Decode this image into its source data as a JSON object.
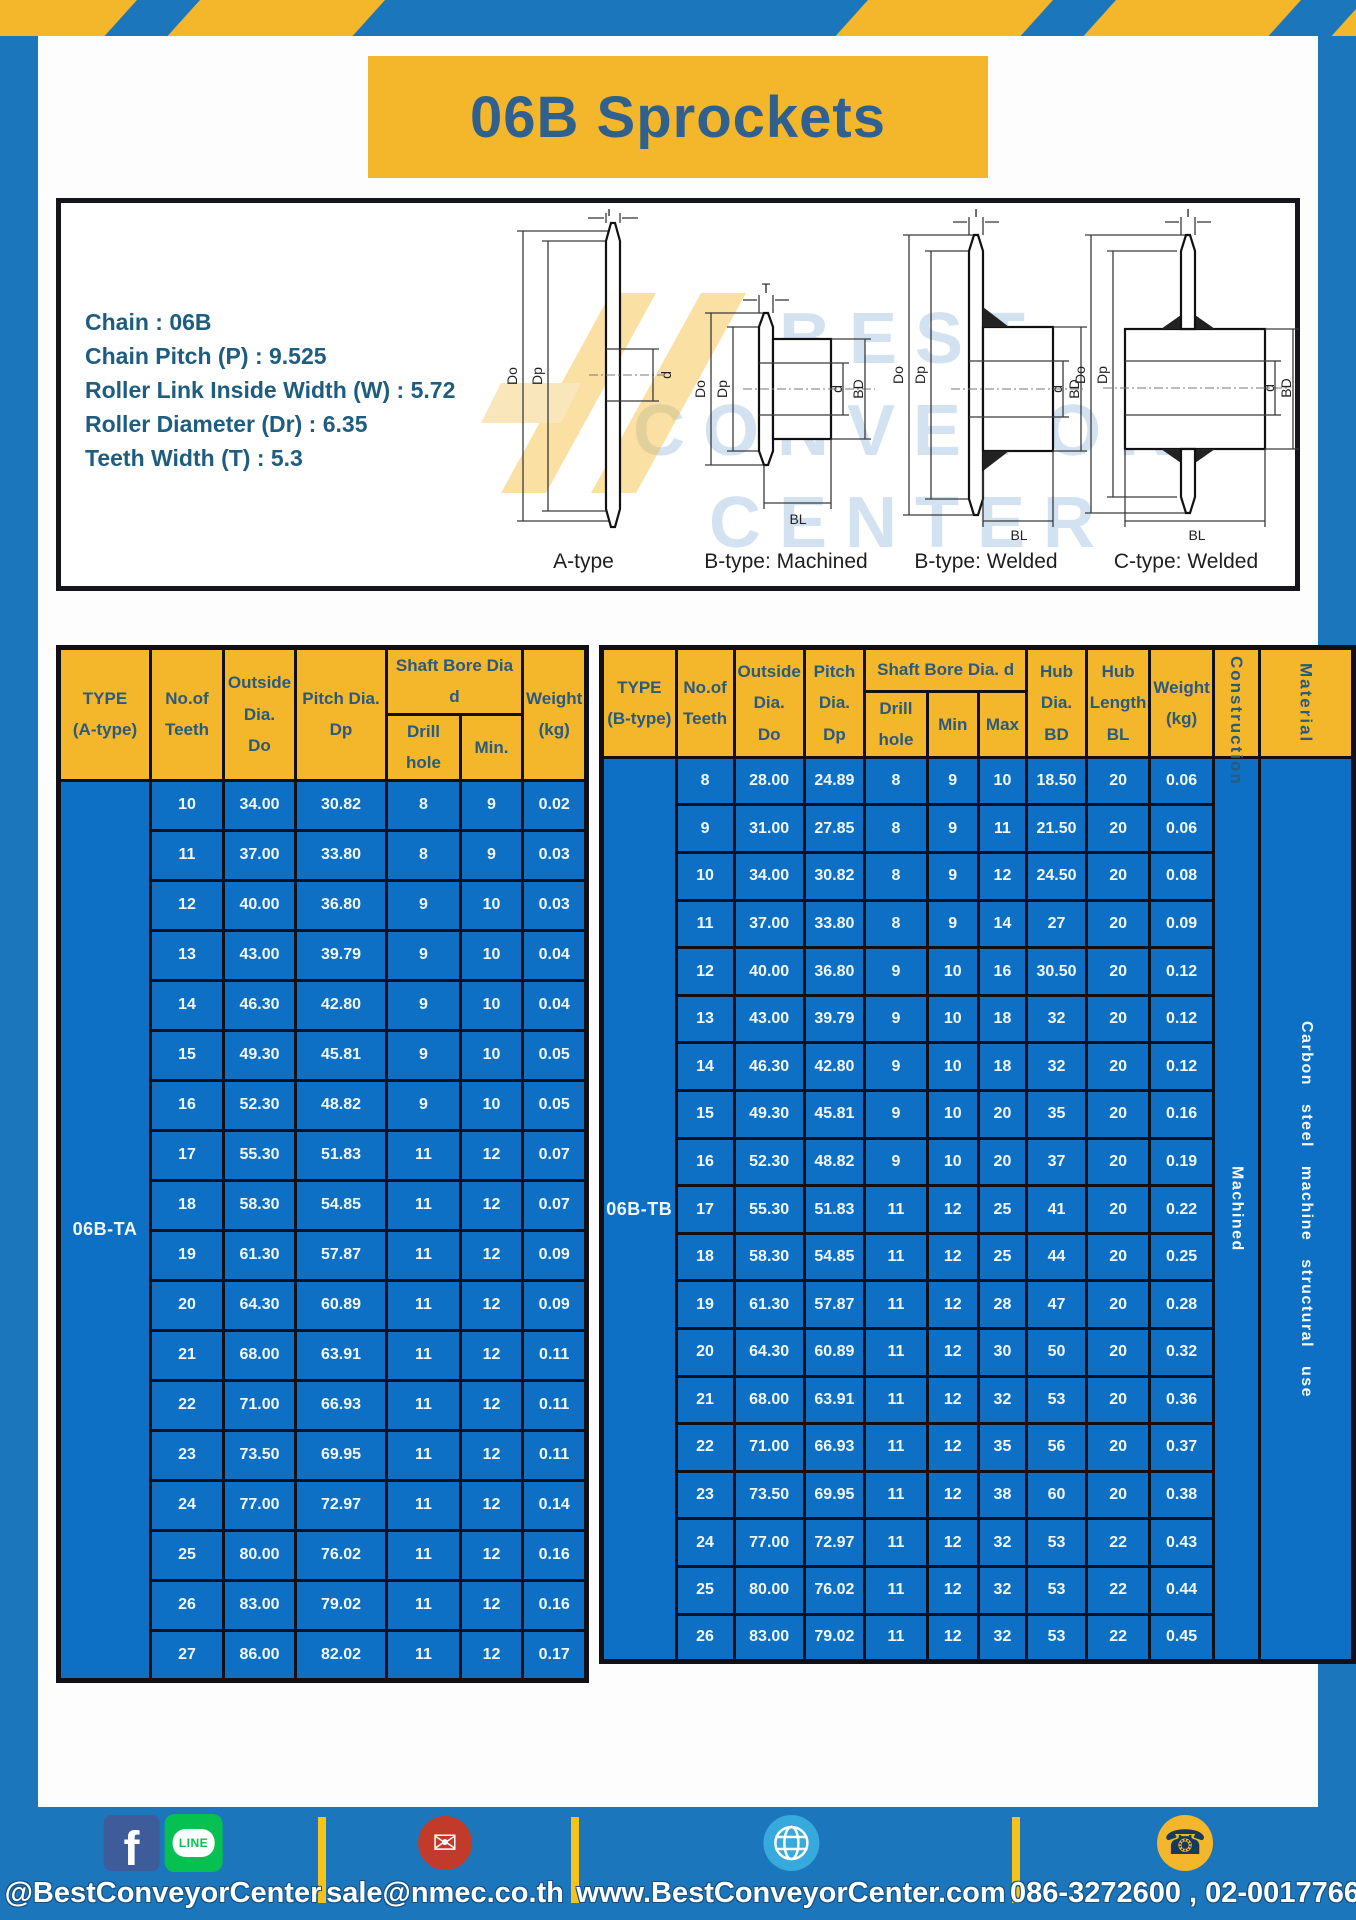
{
  "page": {
    "title": "06B Sprockets"
  },
  "specs": {
    "lines": [
      "Chain  : 06B",
      "Chain Pitch (P)  :  9.525",
      "Roller Link Inside Width (W)  :  5.72",
      "Roller Diameter (Dr)  : 6.35",
      "Teeth Width (T)  :  5.3"
    ]
  },
  "watermark": {
    "line1": "BEST",
    "line2": "CONVEYOR",
    "line3": "CENTER"
  },
  "diagrams": [
    {
      "caption": "A-type",
      "dims": {
        "t": "T",
        "do": "Do",
        "dp": "Dp",
        "d": "d"
      }
    },
    {
      "caption": "B-type: Machined",
      "dims": {
        "t": "T",
        "do": "Do",
        "dp": "Dp",
        "d": "d",
        "bd": "BD",
        "bl": "BL"
      }
    },
    {
      "caption": "B-type: Welded",
      "dims": {
        "t": "T",
        "do": "Do",
        "dp": "Dp",
        "d": "d",
        "bd": "BD",
        "bl": "BL"
      }
    },
    {
      "caption": "C-type: Welded",
      "dims": {
        "t": "T",
        "do": "Do",
        "dp": "Dp",
        "d": "d",
        "bd": "BD",
        "bl": "BL"
      }
    }
  ],
  "tables": {
    "a": {
      "type_label": "06B-TA",
      "headers": {
        "type": "TYPE\n(A-type)",
        "teeth": "No.of\nTeeth",
        "outside": "Outside\nDia.\nDo",
        "pitch": "Pitch Dia.\nDp",
        "shaft_group": "Shaft Bore Dia d",
        "drill": "Drill hole",
        "min": "Min.",
        "weight": "Weight\n(kg)"
      },
      "rows": [
        [
          "10",
          "34.00",
          "30.82",
          "8",
          "9",
          "0.02"
        ],
        [
          "11",
          "37.00",
          "33.80",
          "8",
          "9",
          "0.03"
        ],
        [
          "12",
          "40.00",
          "36.80",
          "9",
          "10",
          "0.03"
        ],
        [
          "13",
          "43.00",
          "39.79",
          "9",
          "10",
          "0.04"
        ],
        [
          "14",
          "46.30",
          "42.80",
          "9",
          "10",
          "0.04"
        ],
        [
          "15",
          "49.30",
          "45.81",
          "9",
          "10",
          "0.05"
        ],
        [
          "16",
          "52.30",
          "48.82",
          "9",
          "10",
          "0.05"
        ],
        [
          "17",
          "55.30",
          "51.83",
          "11",
          "12",
          "0.07"
        ],
        [
          "18",
          "58.30",
          "54.85",
          "11",
          "12",
          "0.07"
        ],
        [
          "19",
          "61.30",
          "57.87",
          "11",
          "12",
          "0.09"
        ],
        [
          "20",
          "64.30",
          "60.89",
          "11",
          "12",
          "0.09"
        ],
        [
          "21",
          "68.00",
          "63.91",
          "11",
          "12",
          "0.11"
        ],
        [
          "22",
          "71.00",
          "66.93",
          "11",
          "12",
          "0.11"
        ],
        [
          "23",
          "73.50",
          "69.95",
          "11",
          "12",
          "0.11"
        ],
        [
          "24",
          "77.00",
          "72.97",
          "11",
          "12",
          "0.14"
        ],
        [
          "25",
          "80.00",
          "76.02",
          "11",
          "12",
          "0.16"
        ],
        [
          "26",
          "83.00",
          "79.02",
          "11",
          "12",
          "0.16"
        ],
        [
          "27",
          "86.00",
          "82.02",
          "11",
          "12",
          "0.17"
        ]
      ]
    },
    "b": {
      "type_label": "06B-TB",
      "headers": {
        "type": "TYPE\n(B-type)",
        "teeth": "No.of\nTeeth",
        "outside": "Outside\nDia.\nDo",
        "pitch": "Pitch\nDia.\nDp",
        "shaft_group": "Shaft Bore Dia.  d",
        "drill": "Drill hole",
        "min": "Min",
        "max": "Max",
        "hub_dia": "Hub\nDia.\nBD",
        "hub_len": "Hub\nLength\nBL",
        "weight": "Weight\n(kg)",
        "construction": "Construction",
        "material": "Material"
      },
      "merged_right": [
        "Machined",
        "Carbon  steel  machine  structural  use"
      ],
      "rows": [
        [
          "8",
          "28.00",
          "24.89",
          "8",
          "9",
          "10",
          "18.50",
          "20",
          "0.06"
        ],
        [
          "9",
          "31.00",
          "27.85",
          "8",
          "9",
          "11",
          "21.50",
          "20",
          "0.06"
        ],
        [
          "10",
          "34.00",
          "30.82",
          "8",
          "9",
          "12",
          "24.50",
          "20",
          "0.08"
        ],
        [
          "11",
          "37.00",
          "33.80",
          "8",
          "9",
          "14",
          "27",
          "20",
          "0.09"
        ],
        [
          "12",
          "40.00",
          "36.80",
          "9",
          "10",
          "16",
          "30.50",
          "20",
          "0.12"
        ],
        [
          "13",
          "43.00",
          "39.79",
          "9",
          "10",
          "18",
          "32",
          "20",
          "0.12"
        ],
        [
          "14",
          "46.30",
          "42.80",
          "9",
          "10",
          "18",
          "32",
          "20",
          "0.12"
        ],
        [
          "15",
          "49.30",
          "45.81",
          "9",
          "10",
          "20",
          "35",
          "20",
          "0.16"
        ],
        [
          "16",
          "52.30",
          "48.82",
          "9",
          "10",
          "20",
          "37",
          "20",
          "0.19"
        ],
        [
          "17",
          "55.30",
          "51.83",
          "11",
          "12",
          "25",
          "41",
          "20",
          "0.22"
        ],
        [
          "18",
          "58.30",
          "54.85",
          "11",
          "12",
          "25",
          "44",
          "20",
          "0.25"
        ],
        [
          "19",
          "61.30",
          "57.87",
          "11",
          "12",
          "28",
          "47",
          "20",
          "0.28"
        ],
        [
          "20",
          "64.30",
          "60.89",
          "11",
          "12",
          "30",
          "50",
          "20",
          "0.32"
        ],
        [
          "21",
          "68.00",
          "63.91",
          "11",
          "12",
          "32",
          "53",
          "20",
          "0.36"
        ],
        [
          "22",
          "71.00",
          "66.93",
          "11",
          "12",
          "35",
          "56",
          "20",
          "0.37"
        ],
        [
          "23",
          "73.50",
          "69.95",
          "11",
          "12",
          "38",
          "60",
          "20",
          "0.38"
        ],
        [
          "24",
          "77.00",
          "72.97",
          "11",
          "12",
          "32",
          "53",
          "22",
          "0.43"
        ],
        [
          "25",
          "80.00",
          "76.02",
          "11",
          "12",
          "32",
          "53",
          "22",
          "0.44"
        ],
        [
          "26",
          "83.00",
          "79.02",
          "11",
          "12",
          "32",
          "53",
          "22",
          "0.45"
        ]
      ]
    }
  },
  "footer": {
    "social_label": "@BestConveyorCenter",
    "email_label": "sale@nmec.co.th",
    "web_label": "www.BestConveyorCenter.com",
    "phone_label": "086-3272600 , 02-0017766",
    "icons": {
      "facebook_glyph": "f",
      "line_text": "LINE",
      "email_glyph": "✉",
      "phone_glyph": "☎"
    }
  },
  "colors": {
    "frame_blue": "#1b76bb",
    "cell_blue": "#0d70c5",
    "accent_yellow": "#f4b62a",
    "header_text": "#2a5a7e"
  }
}
